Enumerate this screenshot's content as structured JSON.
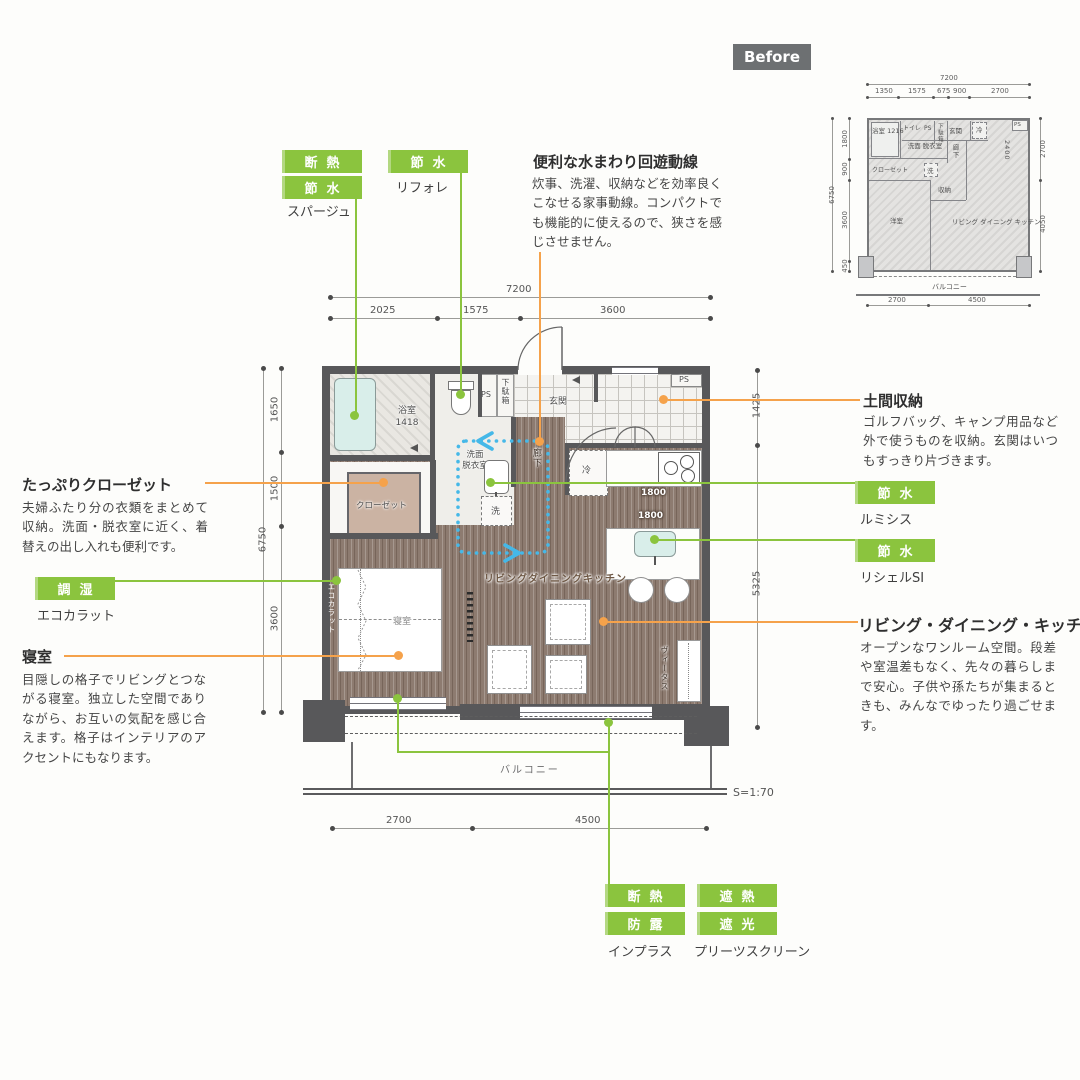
{
  "colors": {
    "green": "#8bc43e",
    "orange": "#f5a24b",
    "blue": "#45b8e8",
    "wall": "#58585a"
  },
  "ann": {
    "sparge": {
      "badges": [
        "断熱",
        "節水"
      ],
      "product": "スパージュ"
    },
    "refore": {
      "badges": [
        "節水"
      ],
      "product": "リフォレ"
    },
    "circulation": {
      "title": "便利な水まわり回遊動線",
      "body": "炊事、洗濯、収納などを効率良くこなせる家事動線。コンパクトでも機能的に使えるので、狭さを感じさせません。"
    },
    "closet": {
      "title": "たっぷりクローゼット",
      "body": "夫婦ふたり分の衣類をまとめて収納。洗面・脱衣室に近く、着替えの出し入れも便利です。"
    },
    "eco": {
      "badges": [
        "調湿"
      ],
      "product": "エコカラット"
    },
    "bedroom": {
      "title": "寝室",
      "body": "目隠しの格子でリビングとつながる寝室。独立した空間でありながら、お互いの気配を感じ合えます。格子はインテリアのアクセントにもなります。"
    },
    "doma": {
      "title": "土間収納",
      "body": "ゴルフバッグ、キャンプ用品など外で使うものを収納。玄関はいつもすっきり片づきます。"
    },
    "lumisis": {
      "badges": [
        "節水"
      ],
      "product": "ルミシス"
    },
    "richelle": {
      "badges": [
        "節水"
      ],
      "product": "リシェルSI"
    },
    "ldk": {
      "title": "リビング・ダイニング・キッチン",
      "body": "オープンなワンルーム空間。段差や室温差もなく、先々の暮らしまで安心。子供や孫たちが集まるときも、みんなでゆったり過ごせます。"
    },
    "inplus": {
      "badges": [
        "断熱",
        "防露"
      ],
      "product": "インプラス"
    },
    "pleats": {
      "badges": [
        "遮熱",
        "遮光"
      ],
      "product": "プリーツスクリーン"
    }
  },
  "plan": {
    "scale": "S=1:70",
    "rooms": {
      "bath": "浴室\n1418",
      "toilet": "トイレ",
      "ps": "PS",
      "geta": "下駄箱",
      "genkan": "玄関",
      "ps2": "PS",
      "senmen": "洗面\n脱衣室",
      "wash": "洗",
      "hall": "廊下",
      "fridge": "冷",
      "closet": "クローゼット",
      "bedroom": "寝室",
      "eco_wall": "エコカラット",
      "ldk": "リビングダイニングキッチン",
      "vitas": "ヴィータス",
      "balcony": "バルコニー",
      "counter1": "1800",
      "counter2": "1800"
    },
    "dims": {
      "top_total": "7200",
      "top": [
        "2025",
        "1575",
        "3600"
      ],
      "left_total": "6750",
      "left": [
        "1650",
        "1500",
        "3600"
      ],
      "right": [
        "1425",
        "5325"
      ],
      "bottom": [
        "2700",
        "4500"
      ]
    }
  },
  "before": {
    "label": "Before",
    "rooms": {
      "bath": "浴室\n1216",
      "toilet": "トイレ",
      "ps": "PS",
      "geta": "下駄箱",
      "genkan": "玄関",
      "fridge": "冷",
      "ps2": "PS",
      "senmen": "洗面\n脱衣室",
      "hall": "廊下",
      "closet": "クローゼット",
      "wash": "洗",
      "shuno": "収納",
      "yoshitsu": "洋室",
      "ldk": "リビング\nダイニング\nキッチン",
      "k2400": "2400",
      "balcony": "バルコニー"
    },
    "dims": {
      "top_total": "7200",
      "top": [
        "1350",
        "1575",
        "675",
        "900",
        "2700"
      ],
      "left_total": "6750",
      "left": [
        "1800",
        "900",
        "3600",
        "450"
      ],
      "right": [
        "2700",
        "4050"
      ],
      "bottom": [
        "2700",
        "4500"
      ]
    }
  }
}
